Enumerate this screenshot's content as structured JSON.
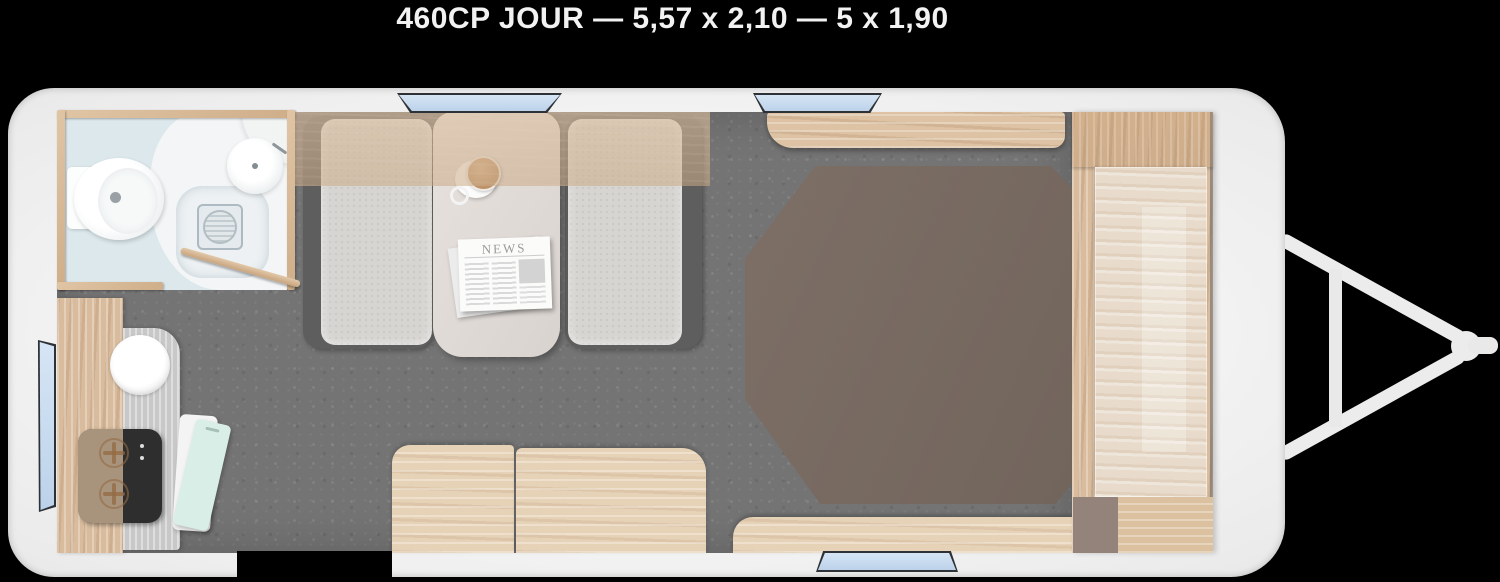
{
  "title": "460CP JOUR — 5,57 x 2,10 — 5 x 1,90",
  "newspaper": {
    "header": "NEWS"
  },
  "plan": {
    "type": "caravan-floorplan-top-view",
    "features": [
      "bathroom-with-toilet-washbasin-shower",
      "kitchen-counter-with-sink-and-hob",
      "open-fridge-door",
      "dinette-two-benches-and-table",
      "overhead-lockers",
      "double-bed",
      "wardrobe",
      "entry-door-opening",
      "four-windows",
      "tow-hitch-a-frame"
    ]
  },
  "colors": {
    "background": "#000000",
    "body_shell": "#f1f1f1",
    "floor": "#747474",
    "wood": "#d9bc9d",
    "wood_light": "#e6d2b6",
    "bed_mattress": "#796b62",
    "window_glass": "#c9dcf0",
    "bathroom_floor": "#dce8ec",
    "bench_cushion": "#d7d5d2",
    "bench_frame": "#5e5e5e",
    "table_top": "#e2ddd9",
    "fridge_mint": "#d9eee7",
    "hob_black": "#2e2e2e",
    "accent_green": "#6f9f85",
    "hitch": "#ececec"
  }
}
